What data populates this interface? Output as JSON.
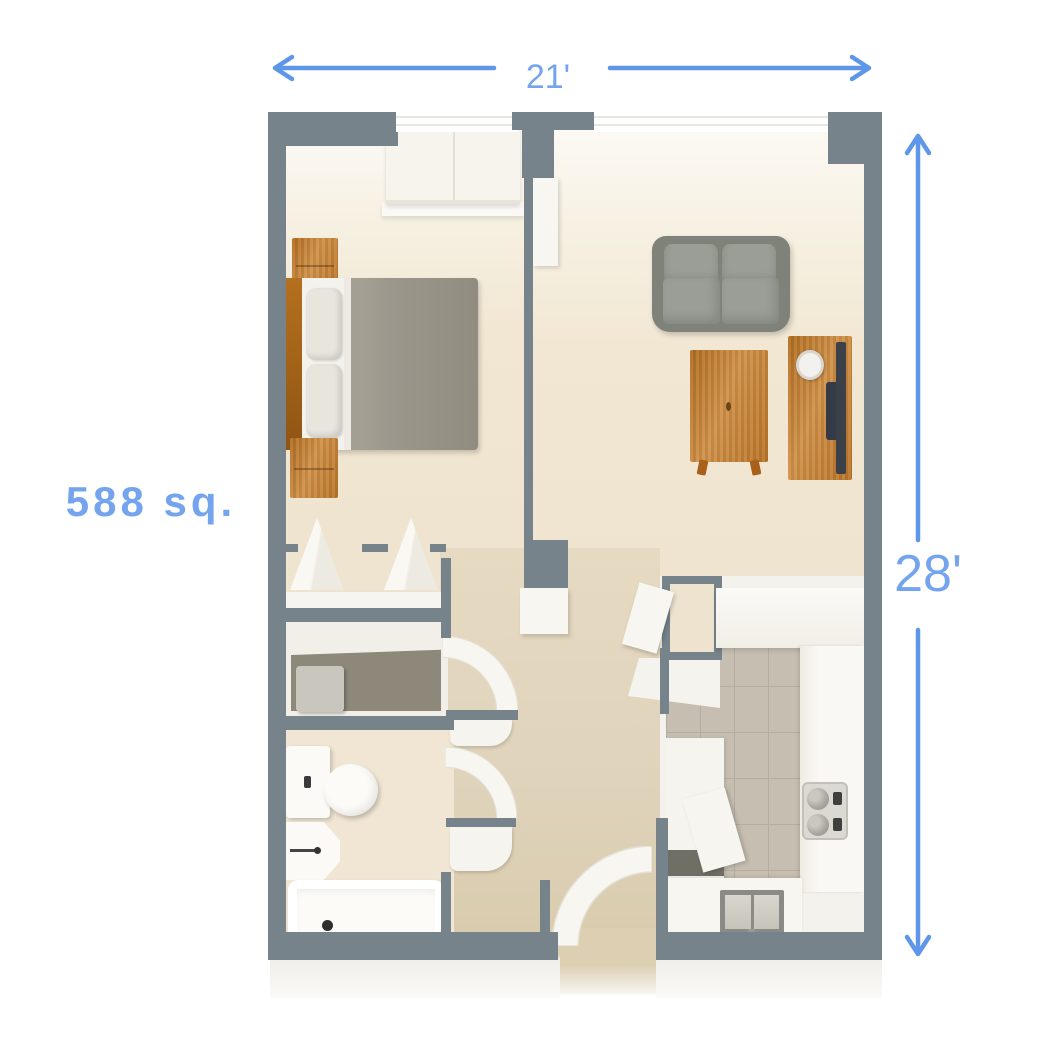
{
  "dimensions": {
    "width_label": "21'",
    "height_label": "28'"
  },
  "area_label": "588 sq.",
  "colors": {
    "accent": "#5E97EA",
    "dimension_text": "#74A4EE",
    "wall": "#76838B",
    "floor_light": "#EFE4CF",
    "floor_tan": "#DFD3BB",
    "tile": "#C6BFB1",
    "wood": "#C8863B",
    "sofa": "#7F8279",
    "cushion": "#9A9E96",
    "blanket": "#9C978C",
    "background": "#FFFFFF"
  }
}
